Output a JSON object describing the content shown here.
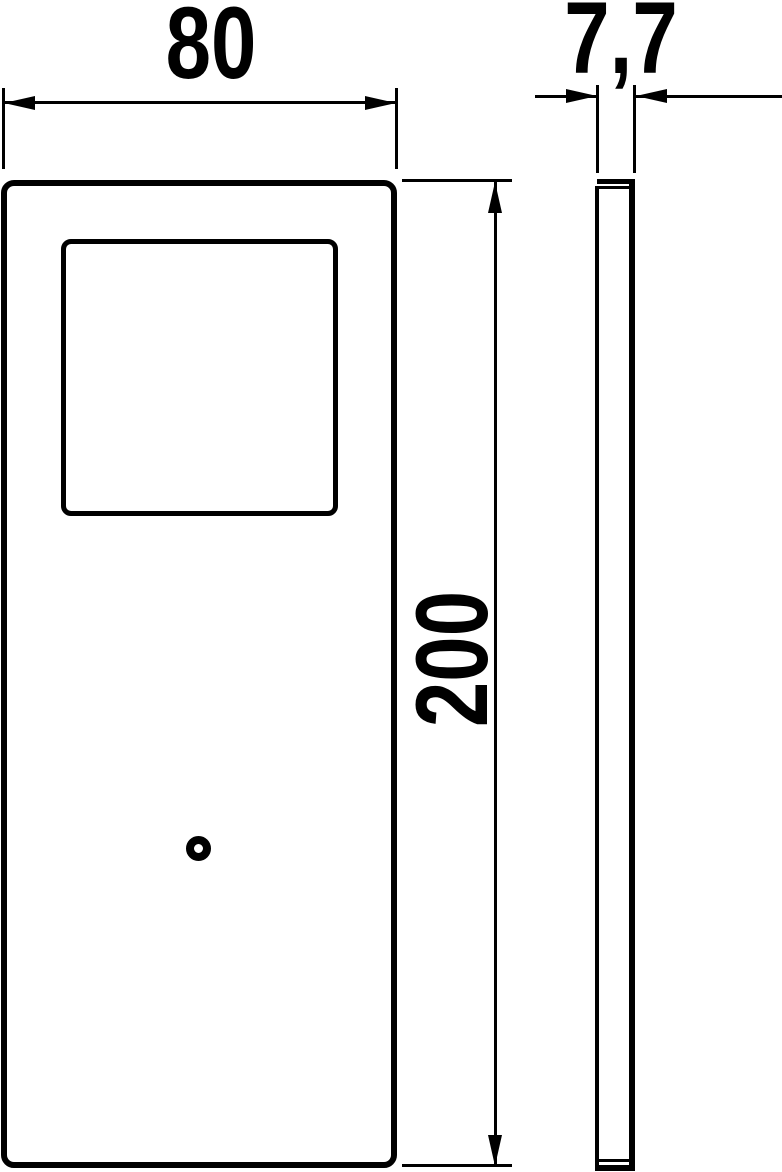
{
  "drawing": {
    "type": "technical-dimension-drawing",
    "colors": {
      "line": "#000000",
      "background": "#ffffff"
    },
    "dimensions": {
      "width_label": "80",
      "thickness_label": "7,7",
      "height_label": "200"
    }
  }
}
